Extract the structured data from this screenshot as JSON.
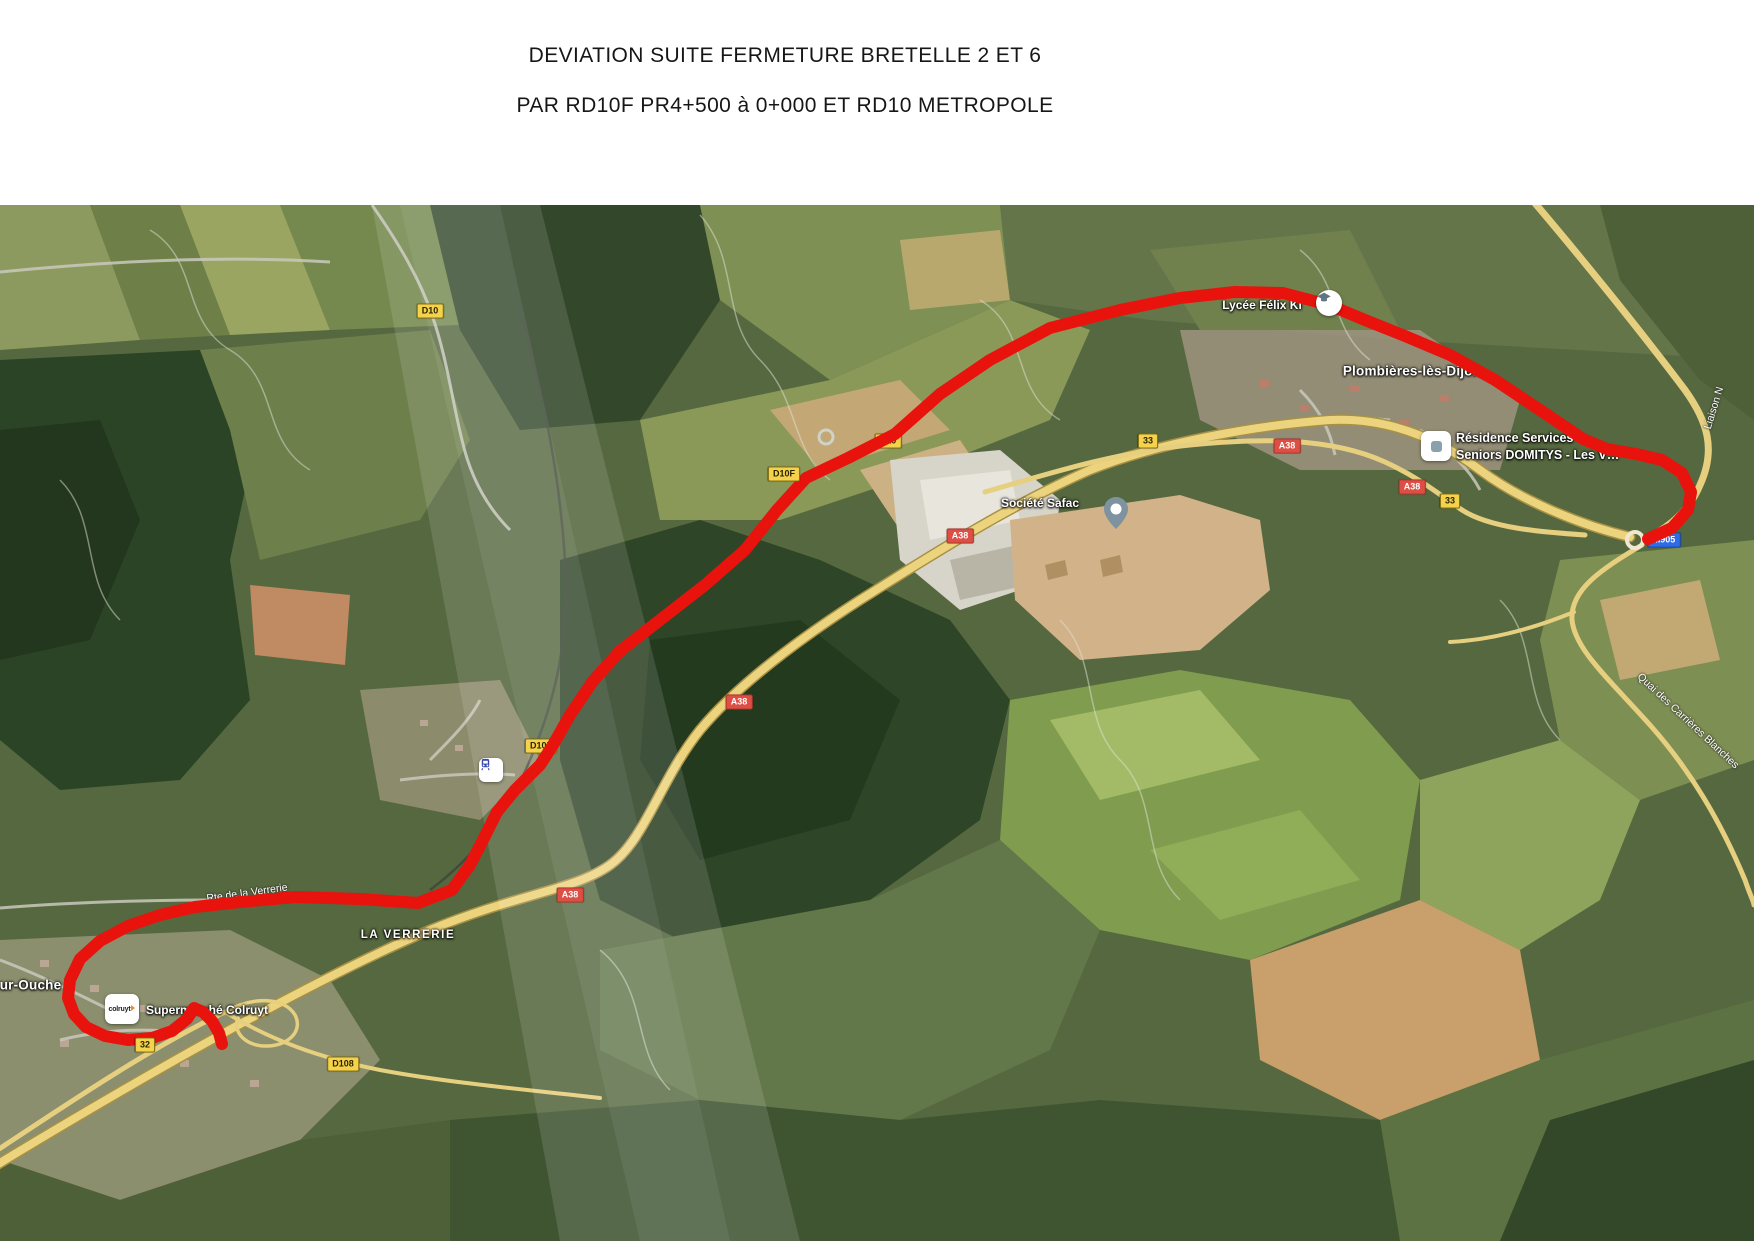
{
  "title": {
    "line1": "DEVIATION SUITE FERMETURE BRETELLE 2 ET 6",
    "line2": "PAR RD10F PR4+500 à 0+000 ET RD10 METROPOLE"
  },
  "map": {
    "towns": {
      "plombieres": "Plombières-lès-Dijon",
      "sur_ouche": "sur-Ouche",
      "la_verrerie": "LA VERRERIE"
    },
    "pois": {
      "lycee": "Lycée Félix Ki",
      "residence_line1": "Résidence Services",
      "residence_line2": "Seniors DOMITYS - Les V…",
      "safac": "Société Safac",
      "colruyt": "Supermarché Colruyt",
      "colruyt_logo": "colruyt"
    },
    "street_labels": {
      "rte_verrerie": "Rte de la Verrerie",
      "liaison": "Liaison N",
      "quai": "Quai des Carrières Blanches"
    },
    "shields": {
      "a38": "A38",
      "d10": "D10",
      "d10f": "D10F",
      "r33": "33",
      "r32": "32",
      "d108": "D108",
      "m905": "M905"
    },
    "colors": {
      "route": "#e8130c",
      "shield_yellow": "#f5d24b",
      "shield_red": "#dd4f44",
      "shield_blue": "#2e6be6",
      "highway_yellow": "#ecd47e"
    }
  }
}
